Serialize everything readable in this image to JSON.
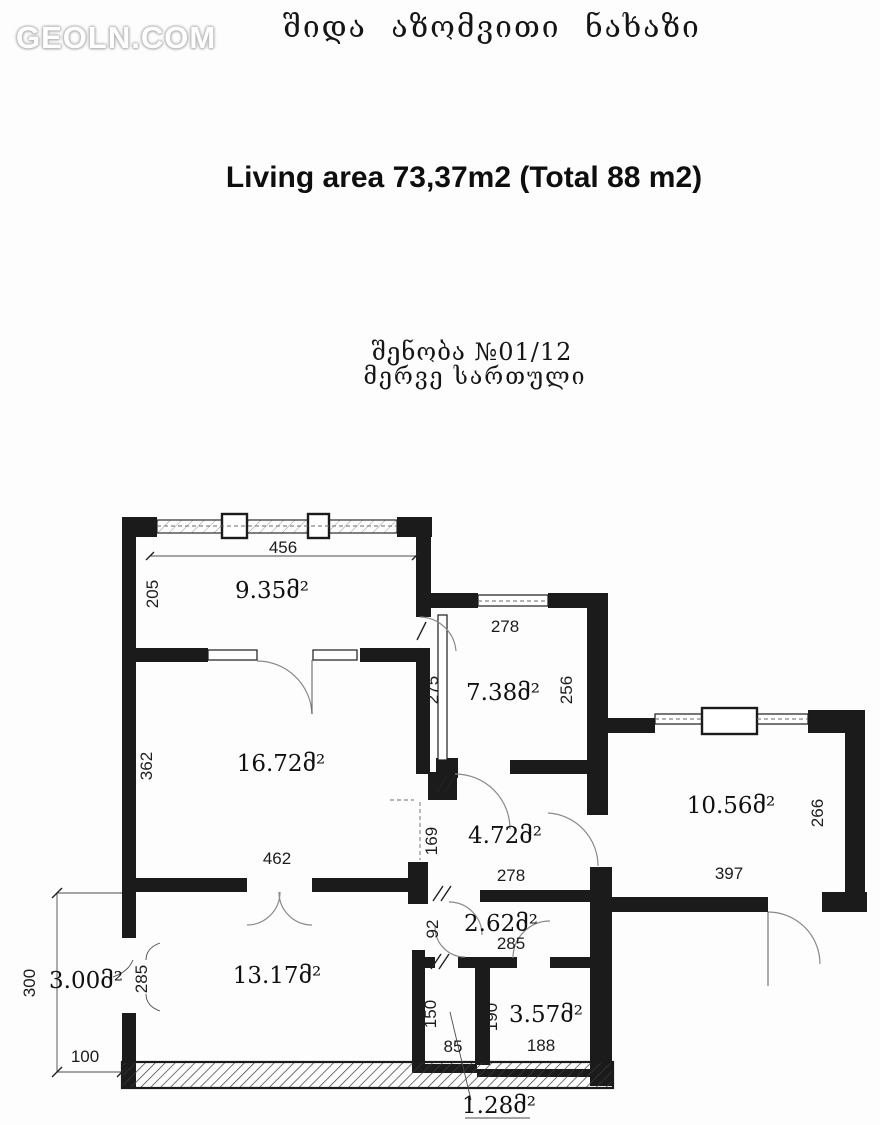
{
  "header": {
    "logo": "GEOLN.COM",
    "title_georgian": "შიდა აზომვითი ნახაზი",
    "area_title": "Living area 73,37m2 (Total 88 m2)",
    "building_no": "შენობა №01/12",
    "floor": "მერვე სართული"
  },
  "plan": {
    "rooms": {
      "r935": "9.35მ²",
      "r738": "7.38მ²",
      "r1672": "16.72მ²",
      "r1056": "10.56მ²",
      "r472": "4.72მ²",
      "r262": "2.62მ²",
      "r1317": "13.17მ²",
      "r300": "3.00მ²",
      "r357": "3.57მ²",
      "r128": "1.28მ²"
    },
    "dims": {
      "d456": "456",
      "d205": "205",
      "d278a": "278",
      "d256": "256",
      "d275": "275",
      "d362": "362",
      "d462": "462",
      "d169": "169",
      "d278b": "278",
      "d397": "397",
      "d266": "266",
      "d92": "92",
      "d285a": "285",
      "d285b": "285",
      "d300": "300",
      "d100": "100",
      "d150": "150",
      "d85": "85",
      "d190": "190",
      "d188": "188"
    }
  }
}
